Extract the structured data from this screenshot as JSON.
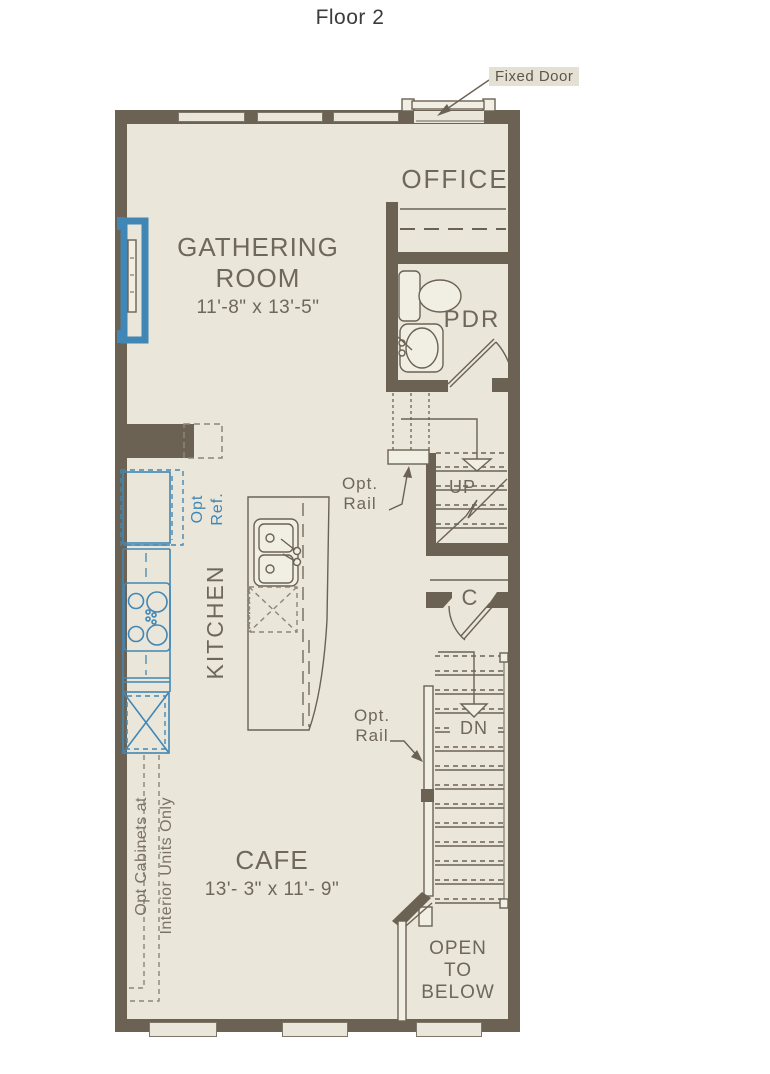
{
  "title": "Floor 2",
  "colors": {
    "wall": "#6b6254",
    "floor": "#eae6da",
    "accent_blue": "#4187b5",
    "text": "#6f675a",
    "callout_text": "#5e5749",
    "callout_bg": "#e4e0d4"
  },
  "callouts": {
    "fixed_door": "Fixed Door",
    "opt_rail": {
      "line1": "Opt.",
      "line2": "Rail"
    },
    "opt_ref": {
      "line1": "Opt",
      "line2": "Ref."
    },
    "opt_cabinets": {
      "line1": "Opt Cabinets at",
      "line2": "Interior Units Only"
    }
  },
  "rooms": {
    "office": {
      "name": "OFFICE"
    },
    "gathering": {
      "line1": "GATHERING",
      "line2": "ROOM",
      "dims": "11'-8\" x 13'-5\""
    },
    "pdr": {
      "name": "PDR"
    },
    "kitchen": {
      "name": "KITCHEN"
    },
    "cafe": {
      "name": "CAFE",
      "dims": "13'- 3\" x 11'- 9\""
    },
    "closet": {
      "name": "C"
    },
    "open_below": {
      "line1": "OPEN",
      "line2": "TO",
      "line3": "BELOW"
    }
  },
  "stairs": {
    "up_label": "UP",
    "down_label": "DN"
  }
}
